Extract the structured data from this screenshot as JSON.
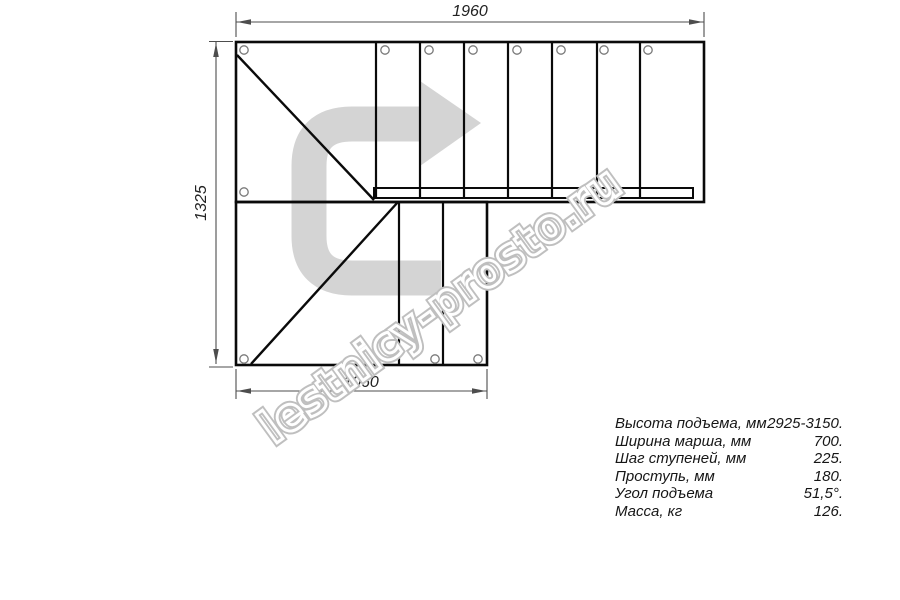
{
  "drawing": {
    "dim_top": "1960",
    "dim_left": "1325",
    "dim_bottom": "1060"
  },
  "watermark": {
    "text": "lestnicy-prosto.ru"
  },
  "specs": {
    "rows": [
      {
        "label": "Высота подъема, мм",
        "value": "2925-3150."
      },
      {
        "label": "Ширина марша, мм",
        "value": "700."
      },
      {
        "label": "Шаг ступеней, мм",
        "value": "225."
      },
      {
        "label": "Проступь, мм",
        "value": "180."
      },
      {
        "label": "Угол подъема",
        "value": "51,5°."
      },
      {
        "label": "Масса, кг",
        "value": "126."
      }
    ]
  },
  "colors": {
    "outline": "#0a0a0a",
    "dimension": "#4d4d4d",
    "direction_arrow": "#d4d4d4",
    "watermark_outline": "#bfbfbf",
    "hole_stroke": "#787878"
  }
}
